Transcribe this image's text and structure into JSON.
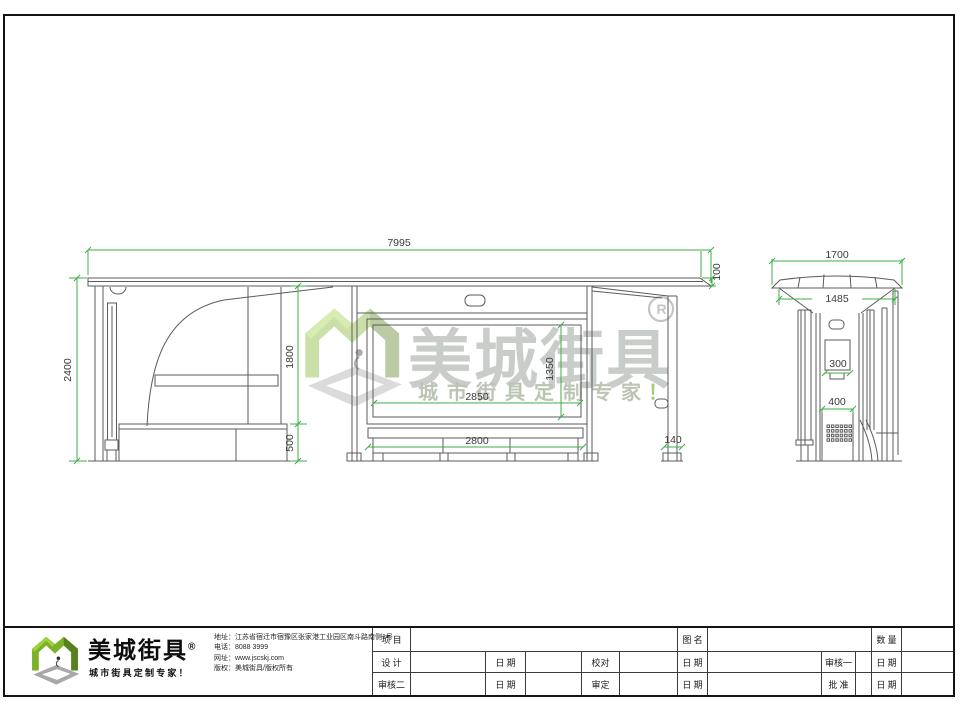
{
  "sheet": {
    "colors": {
      "dim_line": "#3fae49",
      "draw_line": "#5b5b5b",
      "brand_green": "#7cb229",
      "frame": "#141414"
    }
  },
  "watermark": {
    "brand": "美城街具",
    "registered": "R",
    "tagline": "城市街具定制专家",
    "tagline_mark": "！"
  },
  "dims": {
    "front_total_width": "7995",
    "front_total_height": "2400",
    "front_clear_height": "1800",
    "front_base_height": "500",
    "roof_edge_height": "100",
    "ad_panel_width": "2850",
    "ad_panel_height": "1350",
    "bench_width": "2800",
    "post_width": "140",
    "side_roof_width": "1700",
    "side_body_width": "1485",
    "side_panel_width": "300",
    "side_base_width": "400"
  },
  "footer": {
    "logo": {
      "brand": "美城街具",
      "registered": "®",
      "tagline": "城市街具定制专家！"
    },
    "info": [
      {
        "label": "地址：",
        "value": "江苏省宿迁市宿豫区张家港工业园区南斗路南侧1号"
      },
      {
        "label": "电话：",
        "value": "8088 3999"
      },
      {
        "label": "网址：",
        "value": "www.jscskj.com"
      },
      {
        "label": "版权：",
        "value": "美城街具/版权所有"
      }
    ],
    "titleblock": {
      "r1": [
        "项 目",
        "",
        "图 名",
        "",
        "数 量",
        ""
      ],
      "r2": [
        "设 计",
        "",
        "日 期",
        "",
        "校对",
        "",
        "日 期",
        "",
        "审核一",
        "",
        "日 期",
        ""
      ],
      "r3": [
        "审核二",
        "",
        "日 期",
        "",
        "审定",
        "",
        "日 期",
        "",
        "批 准",
        "",
        "日 期",
        ""
      ]
    }
  }
}
